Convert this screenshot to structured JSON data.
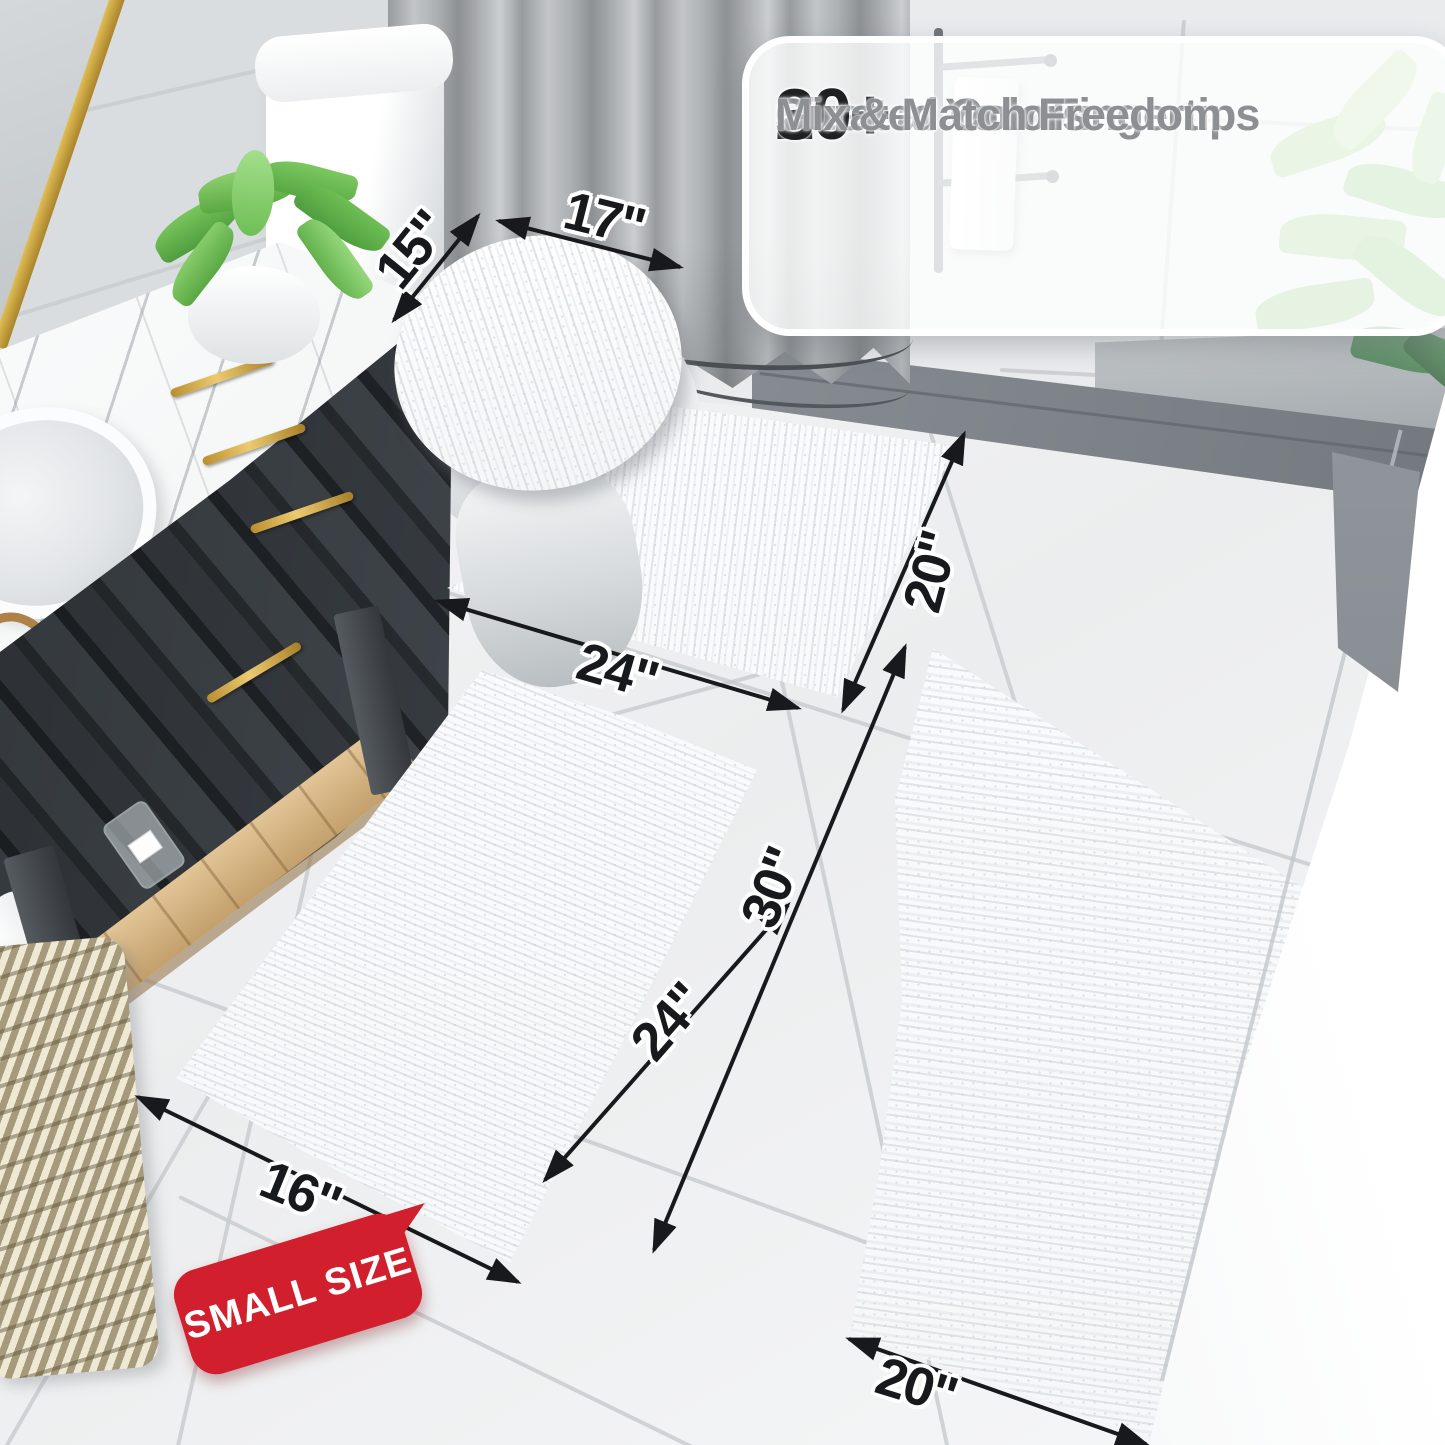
{
  "callout": {
    "check_glyph": "✓",
    "items": [
      {
        "number": "20+",
        "label": "Sizes at Your Fingertips"
      },
      {
        "number": "30+",
        "label": "Curated Colors"
      },
      {
        "number": "",
        "label": "Mix & Match Freedom"
      }
    ]
  },
  "dimensions": {
    "lid_width": "15\"",
    "lid_length": "17\"",
    "contour_depth": "20\"",
    "contour_width": "24\"",
    "small_rug_length": "24\"",
    "large_rug_length": "30\"",
    "small_rug_width": "16\"",
    "large_rug_width": "20\""
  },
  "badge": {
    "label": "SMALL SIZE"
  },
  "colors": {
    "badge_red": "#d21f2d",
    "dimension_ink": "#17191c",
    "callout_number": "#1e2022",
    "callout_label": "#8d9093",
    "check_gray": "#8f9396"
  }
}
